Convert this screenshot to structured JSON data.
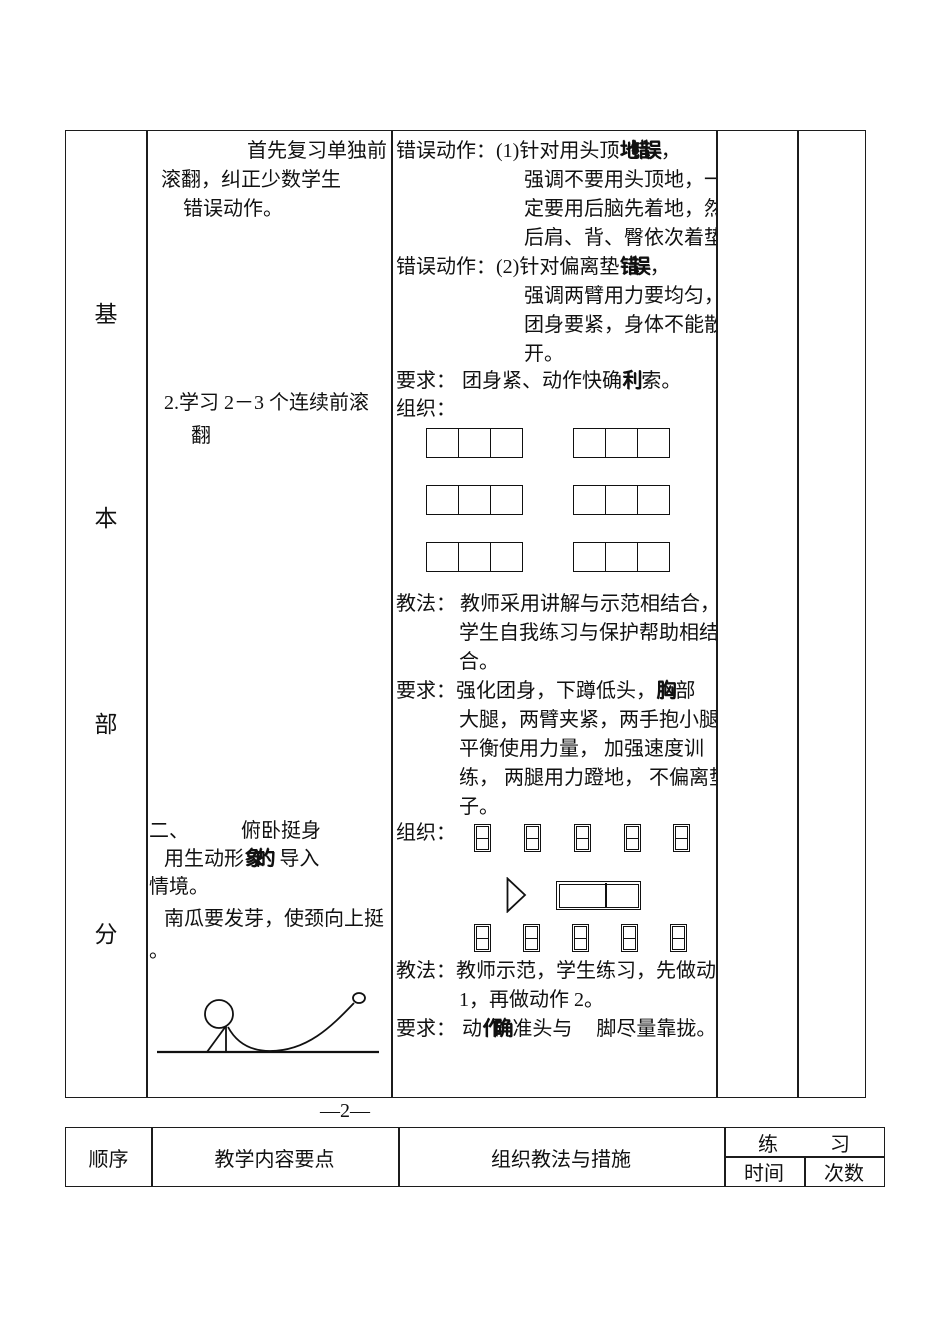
{
  "page_number": "—2—",
  "stage_column": {
    "chars": [
      "基",
      "本",
      "部",
      "分"
    ]
  },
  "content_column": {
    "review": [
      "首先复习单独前",
      "滚翻，纠正少数学生",
      "错误动作。"
    ],
    "learn": [
      "2.学习 2－3 个连续前滚",
      "翻"
    ],
    "section2_num": "二、",
    "section2_title": "俯卧挺身",
    "intro_l1_a": "用生动形",
    "intro_l1_ov": "象的",
    "intro_l1_b": "导入",
    "intro_l2": "情境。",
    "intro_l3": "南瓜要发芽，使颈向上挺",
    "intro_l4": "。"
  },
  "method_column": {
    "err1_label": "错误动作：",
    "err1_head": "(1)针对用头顶",
    "err1_ov": "地错误",
    "err1_tail": "，",
    "err1_lines": [
      "强调不要用头顶地，一",
      "定要用后脑先着地，然",
      "后肩、背、臀依次着垫"
    ],
    "err2_label": "错误动作：",
    "err2_head": "(2)针对偏离垫",
    "err2_ov": "错误",
    "err2_tail": "，",
    "err2_lines": [
      "强调两臂用力要均匀，",
      "团身要紧，身体不能散",
      "开。"
    ],
    "req1_label": "要求：",
    "req1_head": "团身紧、动作快确",
    "req1_ov": "利",
    "req1_tail": "索。",
    "org1_label": "组织：",
    "teach1_label": "教法：",
    "teach1_head": "教师采用讲解与示范相结合，",
    "teach1_lines": [
      "学生自我练习与保护帮助相结",
      "合。"
    ],
    "req2_label": "要求：",
    "req2_head": "强化团身，下蹲低头，",
    "req2_ov": "胸",
    "req2_mid": "部",
    "req2_tail": "贴",
    "req2_lines": [
      "大腿，两臂夹紧，两手抱小腿，",
      "平衡使用力量， 加强速度训",
      "练， 两腿用力蹬地， 不偏离垫",
      "子。"
    ],
    "org2_label": "组织：",
    "teach2_label": "教法：",
    "teach2_head": "教师示范，学生练习，先做动作",
    "teach2_line2": "1，再做动作 2。",
    "req3_label": "要求：",
    "req3_a": "动",
    "req3_ov": "作确",
    "req3_b": "准头与",
    "req3_c": "脚尽量靠拢。"
  },
  "footer_table": {
    "col_order": "顺序",
    "col_content": "教学内容要点",
    "col_method": "组织教法与措施",
    "practice_a": "练",
    "practice_b": "习",
    "time": "时间",
    "count": "次数"
  }
}
